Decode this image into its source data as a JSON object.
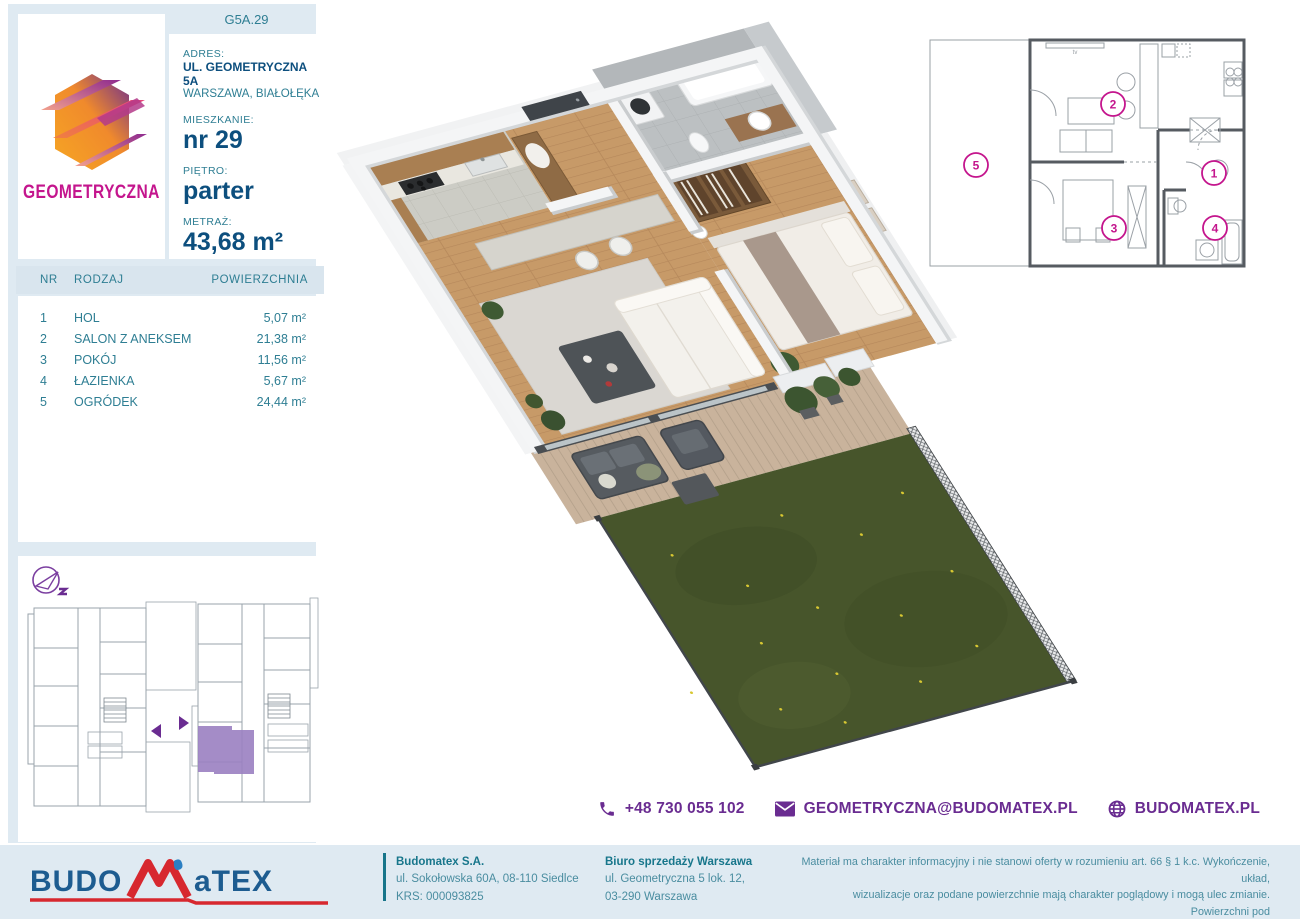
{
  "colors": {
    "panel_blue": "#dfeaf2",
    "label_teal": "#2e7e93",
    "value_navy": "#0d4f7e",
    "logo_magenta": "#c4158d",
    "contact_purple": "#6a2c91",
    "brand_blue": "#1d5c90",
    "brand_red": "#d7282f",
    "highlight_purple": "#9b80c2",
    "lawn_green": "#47552b"
  },
  "logo": {
    "name": "GEOMETRYCZNA"
  },
  "unit_code": "G5A.29",
  "info": {
    "address_label": "ADRES:",
    "address_line1": "UL. GEOMETRYCZNA 5A",
    "address_line2": "WARSZAWA, BIAŁOŁĘKA",
    "apartment_label": "MIESZKANIE:",
    "apartment_value": "nr 29",
    "floor_label": "PIĘTRO:",
    "floor_value": "parter",
    "area_label": "METRAŻ:",
    "area_value": "43,68 m²"
  },
  "table": {
    "headers": {
      "nr": "NR",
      "rodzaj": "RODZAJ",
      "powierzchnia": "POWIERZCHNIA"
    },
    "rows": [
      {
        "nr": "1",
        "rodzaj": "HOL",
        "powierzchnia": "5,07 m²"
      },
      {
        "nr": "2",
        "rodzaj": "SALON Z ANEKSEM",
        "powierzchnia": "21,38 m²"
      },
      {
        "nr": "3",
        "rodzaj": "POKÓJ",
        "powierzchnia": "11,56 m²"
      },
      {
        "nr": "4",
        "rodzaj": "ŁAZIENKA",
        "powierzchnia": "5,67 m²"
      },
      {
        "nr": "5",
        "rodzaj": "OGRÓDEK",
        "powierzchnia": "24,44 m²"
      }
    ]
  },
  "floorplan2d": {
    "n1": "1",
    "n2": "2",
    "n3": "3",
    "n4": "4",
    "n5": "5",
    "tv_label": "tv"
  },
  "contact": {
    "phone": "+48 730 055 102",
    "email": "GEOMETRYCZNA@BUDOMATEX.PL",
    "website": "BUDOMATEX.PL"
  },
  "footer": {
    "brand_part1": "BUDO",
    "brand_part2": "aTEX",
    "company_name": "Budomatex S.A.",
    "company_address": "ul. Sokołowska 60A, 08-110 Siedlce",
    "company_krs": "KRS: 000093825",
    "office_name": "Biuro sprzedaży Warszawa",
    "office_address1": "ul. Geometryczna 5 lok. 12,",
    "office_address2": "03-290 Warszawa",
    "disclaimer_line1": "Materiał ma charakter informacyjny i nie stanowi oferty w rozumieniu art. 66 § 1 k.c. Wykończenie, układ,",
    "disclaimer_line2": "wizualizacje oraz podane powierzchnie mają charakter poglądowy i mogą ulec zmianie. Powierzchni pod",
    "disclaimer_line3": "ściankami działowymi nie wliczamy do powierzchni lokalu."
  }
}
